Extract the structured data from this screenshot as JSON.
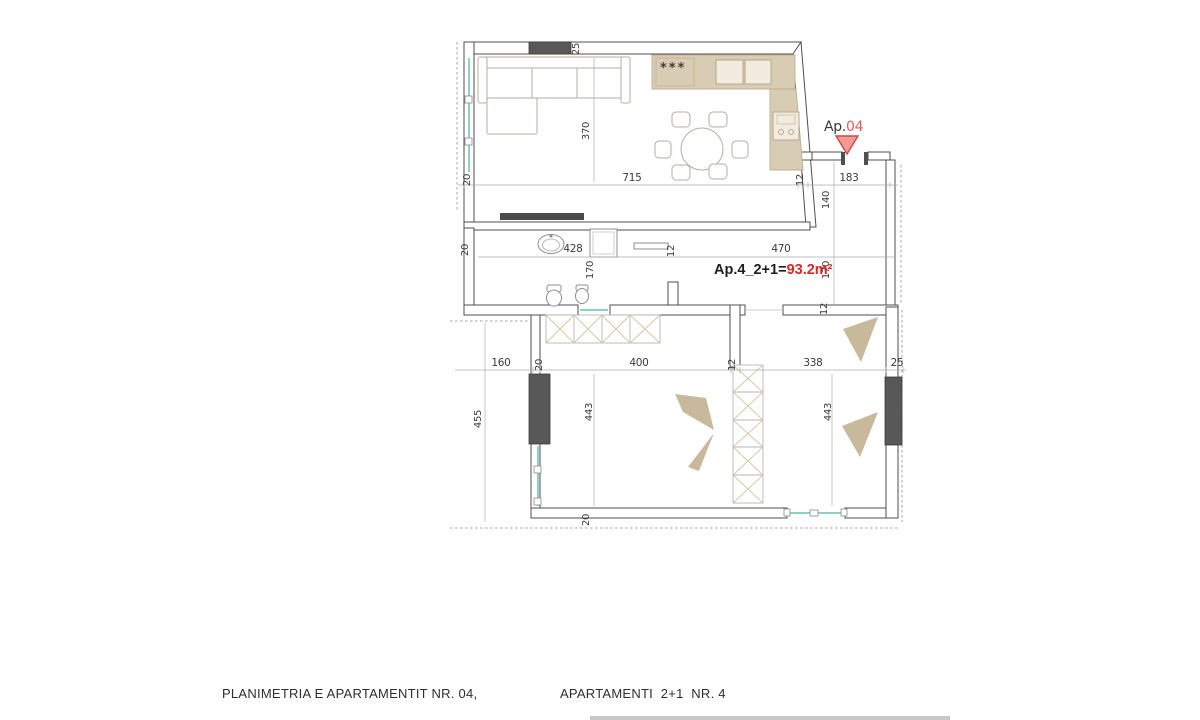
{
  "plan": {
    "marker": {
      "prefix": "Ap.",
      "number": "04"
    },
    "area_label": {
      "name": "Ap.4_2+1=",
      "value": "93.2m²"
    },
    "stove_burners_icon": "***",
    "dims": {
      "top_wall": "25",
      "living_width": "715",
      "living_depth": "370",
      "entry_width": "183",
      "entry_depth": "140",
      "hall_width": "470",
      "hall_depth": "170",
      "bath_width": "428",
      "bath_depth": "170",
      "offset_left": "160",
      "terrace_depth": "455",
      "bed1_width": "400",
      "bed1_depth": "443",
      "bed2_width": "338",
      "bed2_depth": "443",
      "side_wall": "25",
      "wall_thin": "12",
      "wall_thick": "20"
    },
    "colors": {
      "accent_red": "#e05b5b",
      "area_red": "#e02424",
      "counter_beige": "#d9ccb5",
      "window_teal": "#8ed1c8",
      "wall_gray": "#585858"
    }
  },
  "footer": {
    "left_line1": "PLANIMETRIA E APARTAMENTIT NR. 04,",
    "left_line2": " KATI 1 BANIM , SHKALLA B",
    "right": "APARTAMENTI  2+1  NR. 4"
  }
}
